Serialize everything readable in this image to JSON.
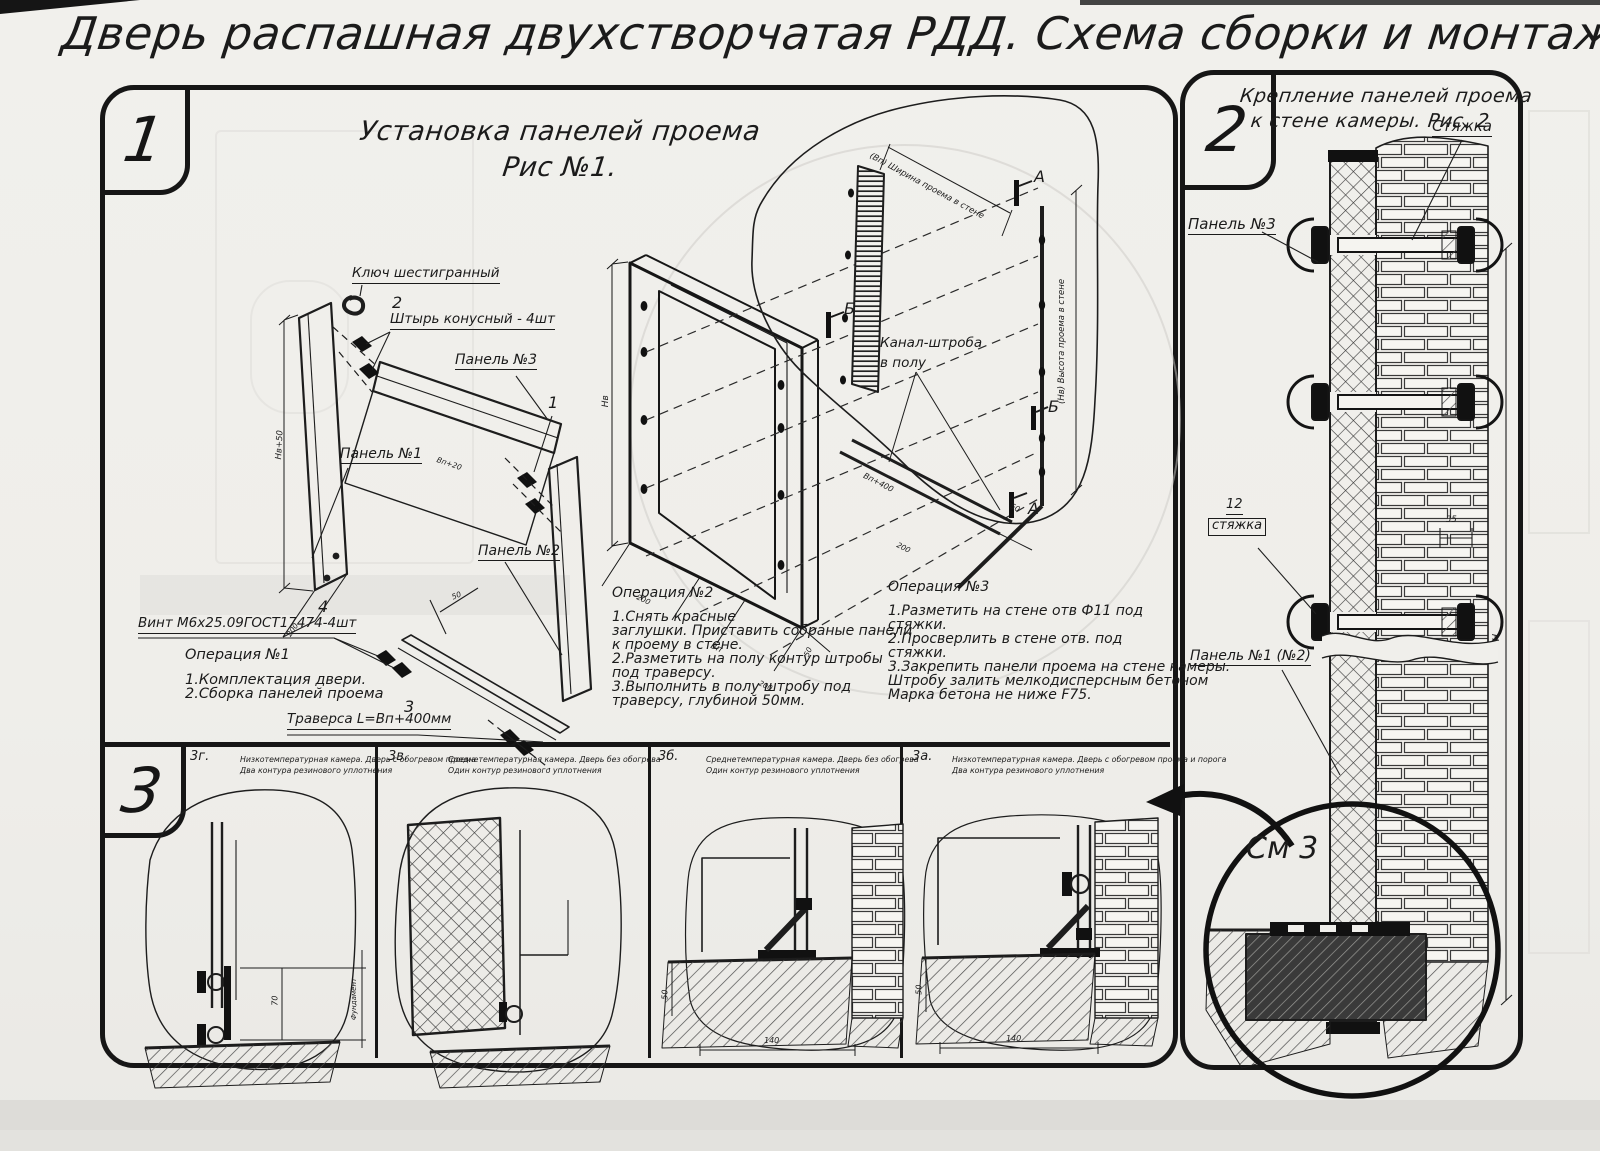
{
  "page": {
    "title": "Дверь распашная двухстворчатая РДД.  Схема сборки и монтажа №2"
  },
  "fig1": {
    "badge": "1",
    "title1": "Установка панелей проема",
    "title2": "Рис №1.",
    "labels": {
      "key": "Ключ шестигранный",
      "pin_num": "2",
      "pin": "Штырь конусный - 4шт",
      "panel3": "Панель №3",
      "panel1": "Панель №1",
      "panel2": "Панель №2",
      "n1": "1",
      "n4": "4",
      "screw": "Винт М6х25.09ГОСТ17474-4шт",
      "n3": "3",
      "traverse": "Траверса  L=Вп+400мм",
      "channel1": "Канал-штроба",
      "channel2": "в полу"
    },
    "markers": {
      "a": "А",
      "b": "Б"
    },
    "dims": {
      "nv50": "Нв+50",
      "d200": "200",
      "vp20": "Вп+20",
      "d50": "50",
      "nv": "Нв",
      "vp": "Вп",
      "d200b": "200",
      "d50b": "50",
      "wall_w": "(Вп) Ширина проема в стене",
      "wall_h": "(Нв) Высота проема в стене",
      "vp400": "Вп+400",
      "d200c": "200",
      "d50c": "50"
    },
    "op1": {
      "title": "Операция №1",
      "l1": "1.Комплектация двери.",
      "l2": "2.Сборка панелей проема"
    },
    "op2": {
      "title": "Операция №2",
      "l1": "1.Снять красные",
      "l2": "заглушки. Приставить собраные панели",
      "l3": "к проему в стене.",
      "l4": "2.Разметить на полу контур штробы",
      "l5": "под траверсу.",
      "l6": "3.Выполнить в полу штробу под",
      "l7": "траверсу, глубиной 50мм."
    },
    "op3": {
      "title": "Операция №3",
      "l1": "1.Разметить на стене отв Ф11 под",
      "l2": "стяжки.",
      "l3": "2.Просверлить в стене отв.  под",
      "l4": "стяжки.",
      "l5": "3.Закрепить панели проема на стене камеры.",
      "l6": "Штробу залить мелкодисперсным бетоном",
      "l7": "Марка бетона не ниже  F75."
    }
  },
  "fig2": {
    "badge": "2",
    "title1": "Крепление панелей проема",
    "title2": "к стене камеры. Рис. 2",
    "tie": "Стяжка",
    "panel3": "Панель №3",
    "n12": "12",
    "tie2": "стяжка",
    "panel12": "Панель №1 (№2)",
    "see3": "См 3",
    "d35": "35",
    "dh": "Н"
  },
  "fig3": {
    "badge": "3",
    "views": [
      {
        "id": "3г.",
        "c1": "Низкотемпературная камера. Дверь с обогревом проема",
        "c2": "Два контура резинового уплотнения"
      },
      {
        "id": "3в.",
        "c1": "Среднетемпературная камера. Дверь без обогрева",
        "c2": "Один контур резинового уплотнения"
      },
      {
        "id": "3б.",
        "c1": "Среднетемпературная камера. Дверь без обогрева",
        "c2": "Один контур резинового уплотнения"
      },
      {
        "id": "3а.",
        "c1": "Низкотемпературная камера. Дверь с обогревом проема и порога",
        "c2": "Два контура резинового уплотнения"
      }
    ],
    "dims": {
      "d70": "70",
      "fund": "Фундамент",
      "d50": "50",
      "d140": "140"
    }
  },
  "colors": {
    "paper": "#f0efeb",
    "ink": "#1b1b1b",
    "ghost": "#cfcec9"
  }
}
